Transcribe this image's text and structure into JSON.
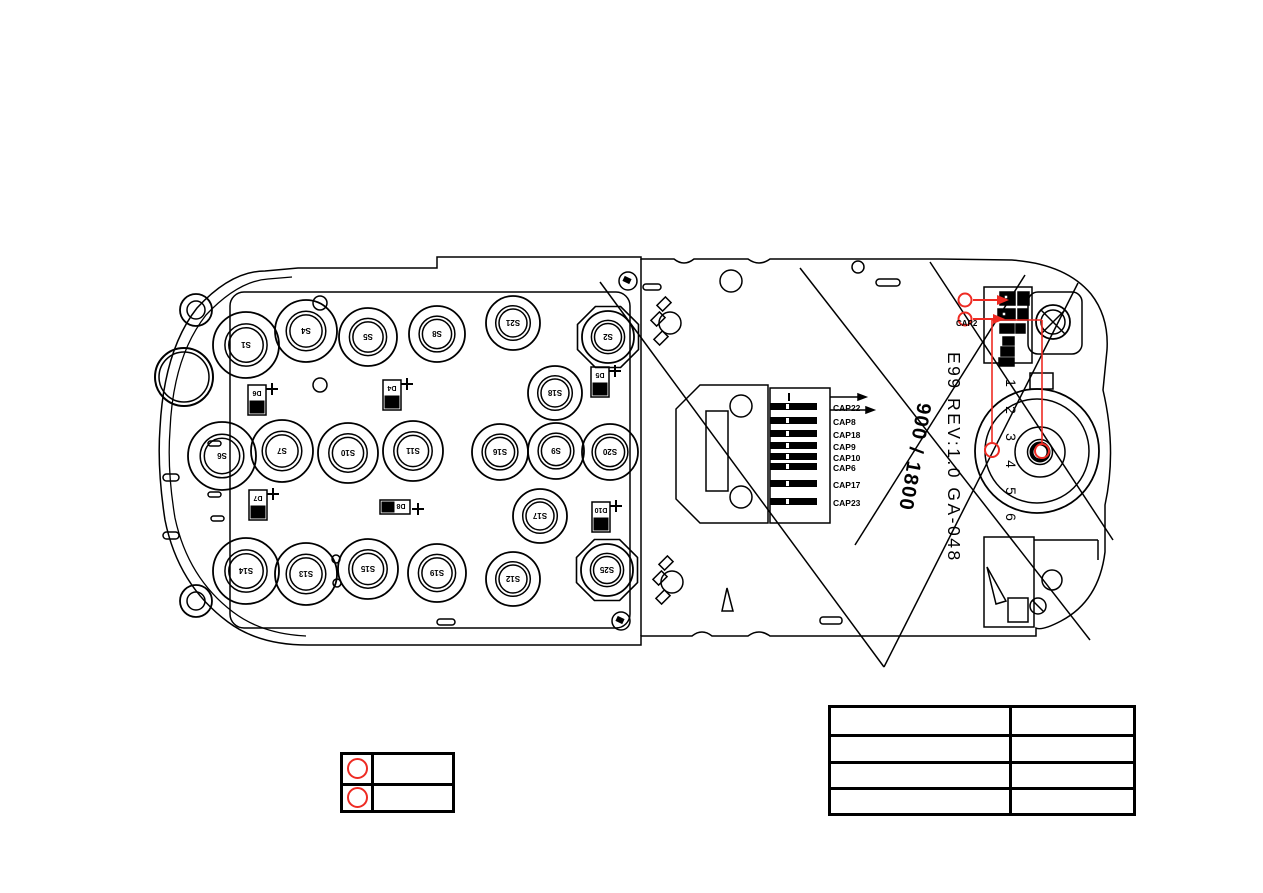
{
  "colors": {
    "ink": "#000000",
    "highlight_red": "#ee2b23"
  },
  "annotations": {
    "board_code": "E99 REV:1.0 GA-048",
    "band_label": "900 / 1800",
    "cap2_label": "CAP2",
    "connector_pin_labels": [
      "1",
      "2",
      "3",
      "4",
      "5",
      "6"
    ]
  },
  "connector_caps": [
    "CAP22",
    "CAP8",
    "CAP18",
    "CAP9",
    "CAP10",
    "CAP6",
    "CAP17",
    "CAP23"
  ],
  "keypad_switches": [
    {
      "label": "S1",
      "x": 246,
      "y": 345,
      "r": 33,
      "pad": "round"
    },
    {
      "label": "S4",
      "x": 306,
      "y": 331,
      "r": 31,
      "pad": "round"
    },
    {
      "label": "S5",
      "x": 368,
      "y": 337,
      "r": 29,
      "pad": "round"
    },
    {
      "label": "S8",
      "x": 437,
      "y": 334,
      "r": 28,
      "pad": "round"
    },
    {
      "label": "S21",
      "x": 513,
      "y": 323,
      "r": 27,
      "pad": "round"
    },
    {
      "label": "S2",
      "x": 608,
      "y": 337,
      "r": 26,
      "pad": "octagon"
    },
    {
      "label": "S18",
      "x": 555,
      "y": 393,
      "r": 27,
      "pad": "round"
    },
    {
      "label": "S6",
      "x": 222,
      "y": 456,
      "r": 34,
      "pad": "round"
    },
    {
      "label": "S7",
      "x": 282,
      "y": 451,
      "r": 31,
      "pad": "round"
    },
    {
      "label": "S10",
      "x": 348,
      "y": 453,
      "r": 30,
      "pad": "round"
    },
    {
      "label": "S11",
      "x": 413,
      "y": 451,
      "r": 30,
      "pad": "round"
    },
    {
      "label": "S16",
      "x": 500,
      "y": 452,
      "r": 28,
      "pad": "round"
    },
    {
      "label": "S9",
      "x": 556,
      "y": 451,
      "r": 28,
      "pad": "round"
    },
    {
      "label": "S20",
      "x": 610,
      "y": 452,
      "r": 28,
      "pad": "round"
    },
    {
      "label": "S17",
      "x": 540,
      "y": 516,
      "r": 27,
      "pad": "round"
    },
    {
      "label": "S14",
      "x": 246,
      "y": 571,
      "r": 33,
      "pad": "round"
    },
    {
      "label": "S13",
      "x": 306,
      "y": 574,
      "r": 31,
      "pad": "round"
    },
    {
      "label": "S15",
      "x": 368,
      "y": 569,
      "r": 30,
      "pad": "round"
    },
    {
      "label": "S19",
      "x": 437,
      "y": 573,
      "r": 29,
      "pad": "round"
    },
    {
      "label": "S12",
      "x": 513,
      "y": 579,
      "r": 27,
      "pad": "round"
    },
    {
      "label": "S25",
      "x": 607,
      "y": 570,
      "r": 26,
      "pad": "octagon"
    }
  ],
  "led_refs": [
    {
      "label": "D6",
      "x": 257,
      "y": 400,
      "orient": "v"
    },
    {
      "label": "D4",
      "x": 392,
      "y": 395,
      "orient": "v"
    },
    {
      "label": "D5",
      "x": 600,
      "y": 382,
      "orient": "v"
    },
    {
      "label": "D7",
      "x": 258,
      "y": 505,
      "orient": "v"
    },
    {
      "label": "D8",
      "x": 395,
      "y": 507,
      "orient": "h"
    },
    {
      "label": "D10",
      "x": 601,
      "y": 517,
      "orient": "v"
    }
  ],
  "legend_table": {
    "rows": [
      {
        "marker": "red-circle",
        "label": ""
      },
      {
        "marker": "red-circle",
        "label": ""
      }
    ]
  },
  "notes_table": {
    "rows": [
      [
        "",
        ""
      ],
      [
        "",
        ""
      ],
      [
        "",
        ""
      ],
      [
        "",
        ""
      ]
    ]
  }
}
